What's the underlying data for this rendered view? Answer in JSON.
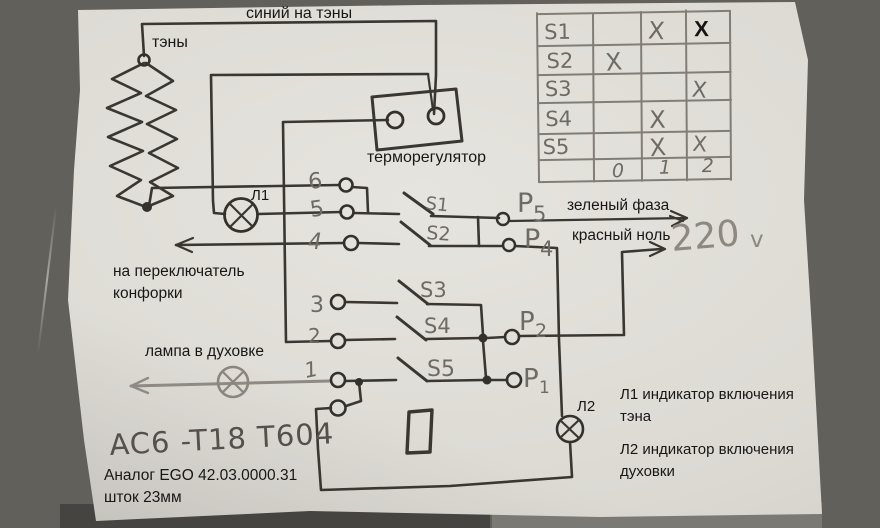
{
  "labels": {
    "blue_to_heaters": "синий на тэны",
    "heaters": "тэны",
    "thermostat": "терморегулятор",
    "l1": "Л1",
    "l2": "Л2",
    "green_phase": "зеленый фаза",
    "red_neutral": "красный ноль",
    "to_burner_line1": "на переключатель",
    "to_burner_line2": "конфорки",
    "oven_lamp": "лампа в духовке",
    "l1_desc_line1": "Л1 индикатор включения",
    "l1_desc_line2": "тэна",
    "l2_desc_line1": "Л2 индикатор включения",
    "l2_desc_line2": "духовки",
    "analog_line1": "Аналог EGO 42.03.0000.31",
    "analog_line2": "шток 23мм"
  },
  "handwritten": {
    "model": "AC6 -T18 T604",
    "voltage": "220",
    "voltage_unit": "v",
    "pins": [
      "6",
      "5",
      "4",
      "3",
      "2",
      "1"
    ],
    "switches": [
      "S1",
      "S2",
      "S3",
      "S4",
      "S5"
    ],
    "outputs": [
      {
        "p": "P",
        "n": "5"
      },
      {
        "p": "P",
        "n": "4"
      },
      {
        "p": "P",
        "n": "2"
      },
      {
        "p": "P",
        "n": "1"
      }
    ]
  },
  "switch_table": {
    "rows": [
      {
        "name": "S1",
        "c0": "",
        "c1": "X",
        "c2": "X"
      },
      {
        "name": "S2",
        "c0": "X",
        "c1": "",
        "c2": ""
      },
      {
        "name": "S3",
        "c0": "",
        "c1": "",
        "c2": "X"
      },
      {
        "name": "S4",
        "c0": "",
        "c1": "X",
        "c2": ""
      },
      {
        "name": "S5",
        "c0": "",
        "c1": "X",
        "c2": "X"
      }
    ],
    "footer": [
      "0",
      "1",
      "2"
    ]
  }
}
